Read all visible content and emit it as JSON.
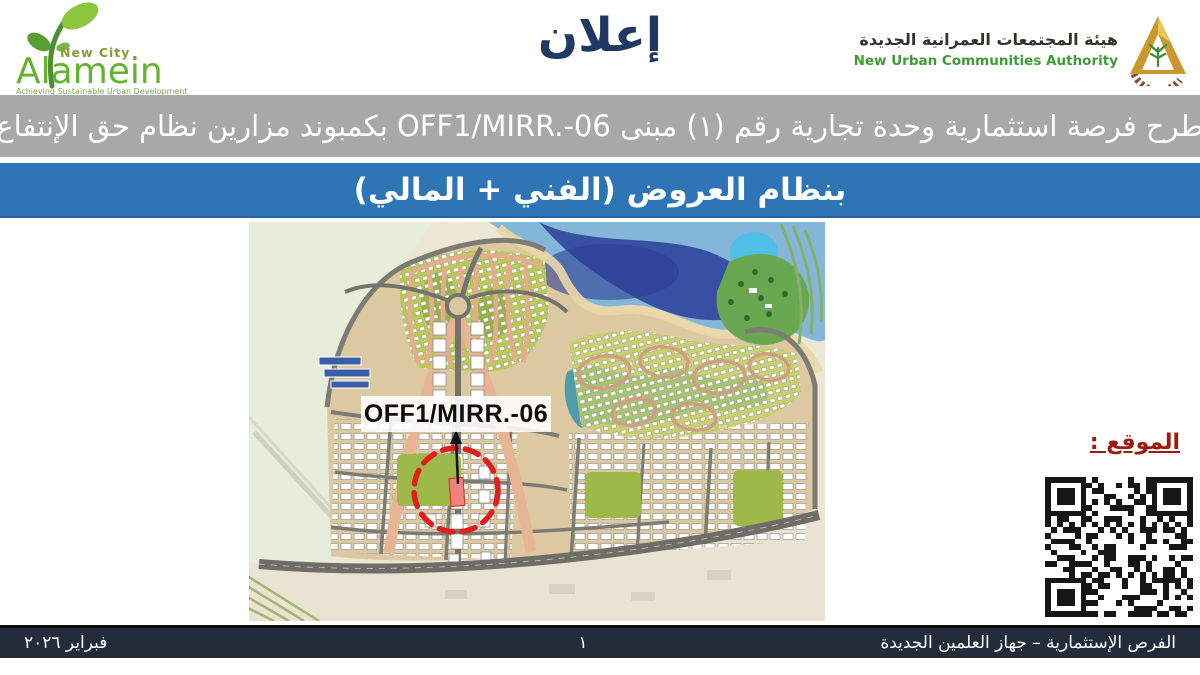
{
  "header": {
    "title": "إعلان",
    "alamein_logo": {
      "top": "New City",
      "name": "Alamein",
      "tagline": "Achieving Sustainable Urban Development"
    },
    "nuca_logo": {
      "name_ar": "هيئة المجتمعات العمرانية الجديدة",
      "name_en": "New Urban Communities Authority"
    }
  },
  "banners": {
    "gray_text": "طرح فرصة استثمارية وحدة تجارية رقم (١) مبنى OFF1/MIRR.-06 بكمبوند مزارين نظام حق الإنتفاع",
    "blue_text": "بنظام العروض (الفني + المالي)"
  },
  "map": {
    "unit_label": "OFF1/MIRR.-06"
  },
  "location": {
    "label": "الموقع :"
  },
  "footer": {
    "date": "فبراير ٢٠٢٦",
    "page_number": "١",
    "department": "الفرص الإستثمارية – جهاز العلمين الجديدة"
  },
  "colors": {
    "banner_gray": "#a8a8a8",
    "banner_blue": "#2e75b6",
    "footer_bg": "#222c3a",
    "title_blue": "#1f3864",
    "location_red": "#9c1c0e",
    "highlight_red": "#e21d1d",
    "alamein_green": "#6ab04c",
    "nuca_green": "#3f9c35",
    "gold": "#c9992f"
  }
}
